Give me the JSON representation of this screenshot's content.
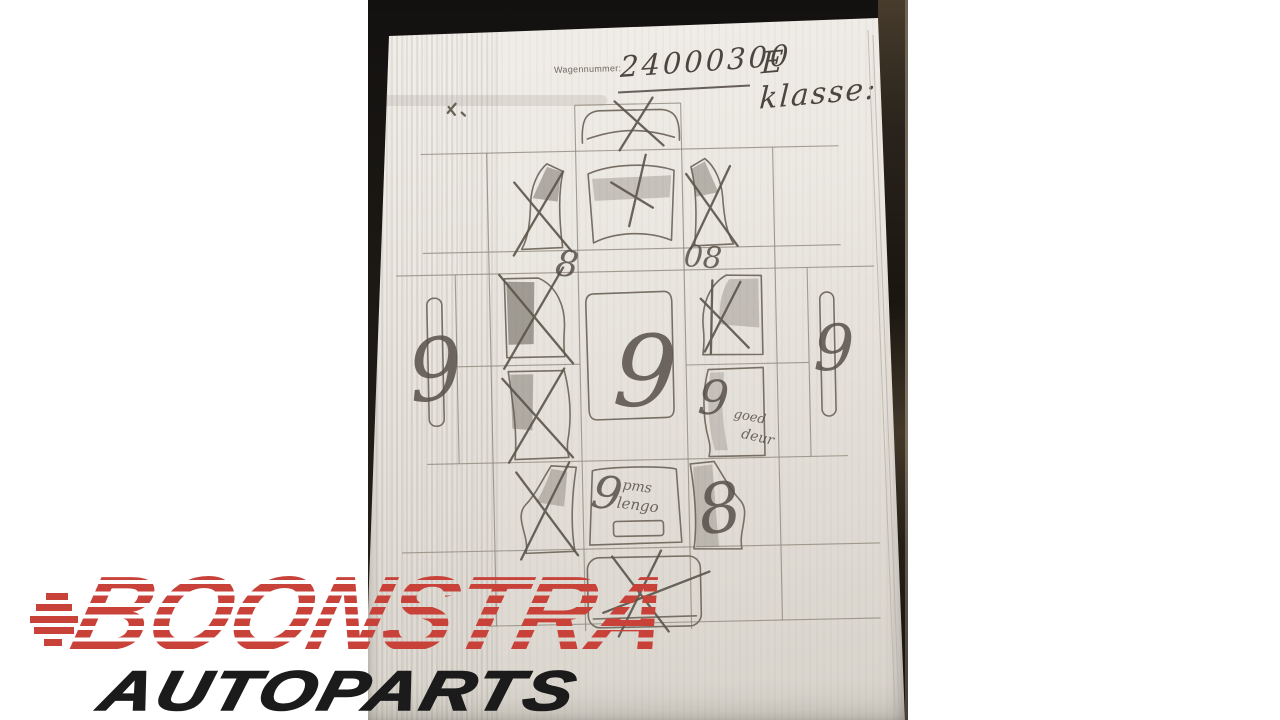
{
  "logo": {
    "title": "BOONSTRA",
    "subtitle": "AUTOPARTS"
  },
  "form": {
    "field_label": "Wagennummer:",
    "field_value": "24000300",
    "model_note": "E klasse:",
    "marks": {
      "left_fender_below": "8",
      "hood_below_right": "08",
      "left_sill": "9",
      "roof": "9",
      "right_sill": "9",
      "right_rear_door": "9",
      "right_rear_door_note_1": "goed",
      "right_rear_door_note_2": "deur",
      "trunk": "9",
      "trunk_note_1": "pms",
      "trunk_note_2": "lengo",
      "right_quarter_panel": "8"
    },
    "parts": [
      {
        "name": "front-bumper",
        "status": "crossed-out"
      },
      {
        "name": "left-front-fender",
        "status": "crossed-out"
      },
      {
        "name": "hood",
        "status": "crossed-out"
      },
      {
        "name": "right-front-fender",
        "status": "crossed-out"
      },
      {
        "name": "left-sill",
        "status": "marked-9"
      },
      {
        "name": "left-front-door",
        "status": "crossed-out"
      },
      {
        "name": "left-rear-door",
        "status": "crossed-out"
      },
      {
        "name": "roof",
        "status": "marked-9"
      },
      {
        "name": "right-front-door",
        "status": "crossed-out"
      },
      {
        "name": "right-rear-door",
        "status": "marked-9"
      },
      {
        "name": "right-sill",
        "status": "marked-9"
      },
      {
        "name": "left-quarter-panel",
        "status": "crossed-out"
      },
      {
        "name": "trunk-lid",
        "status": "marked-9"
      },
      {
        "name": "right-quarter-panel",
        "status": "marked-8"
      },
      {
        "name": "rear-bumper",
        "status": "crossed-out"
      }
    ]
  },
  "colors": {
    "canvas": "#ffffff",
    "photo_background": "#1b1814",
    "paper": "#e9e5df",
    "pencil": "#6b645a",
    "logo_red": "#c9423a",
    "logo_black": "#1b1b1b"
  }
}
